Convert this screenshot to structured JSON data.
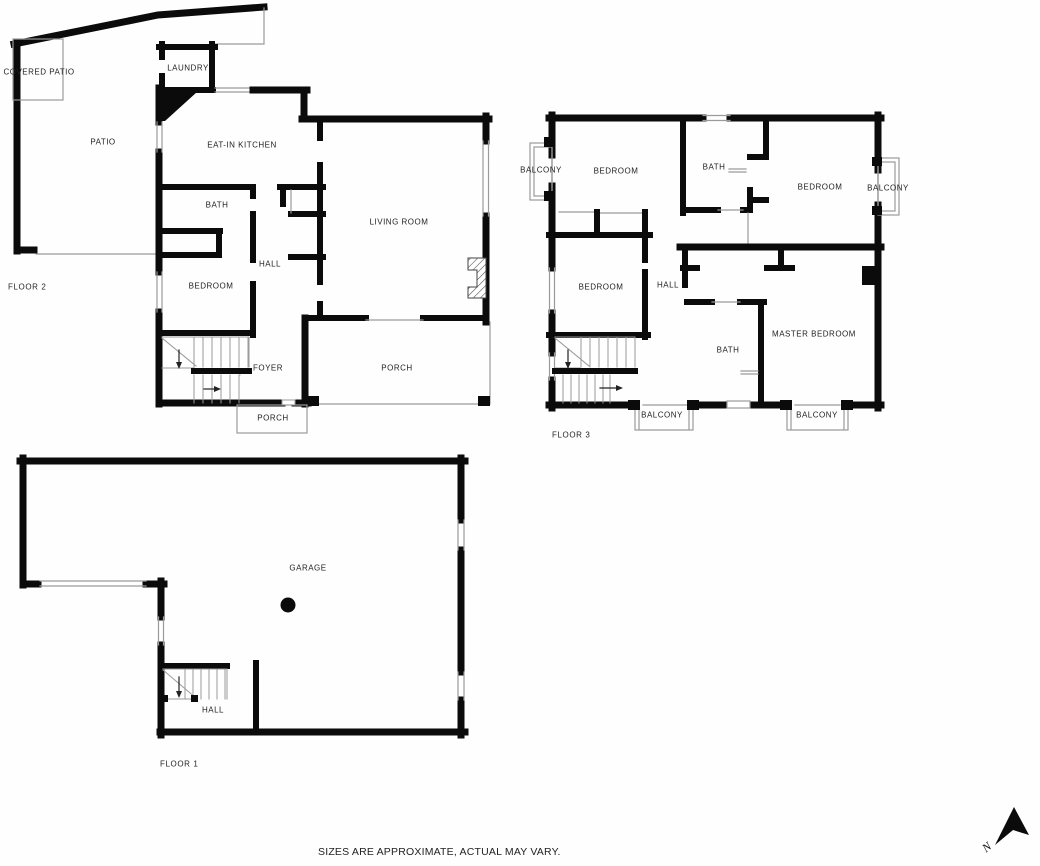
{
  "meta": {
    "title": "Three-floor residential floor plan",
    "wall_color": "#0b0b0b",
    "thin_line_color": "#9a9a9a",
    "background": "#fefefe"
  },
  "disclaimer": {
    "text": "SIZES ARE APPROXIMATE, ACTUAL MAY VARY."
  },
  "compass": {
    "label": "N",
    "icon": "north-arrow-icon"
  },
  "floors": [
    {
      "id": "floor-2",
      "name_label": {
        "text": "FLOOR 2",
        "x": 8,
        "y": 287
      },
      "rooms": [
        {
          "label": "COVERED PATIO",
          "x": 39,
          "y": 72
        },
        {
          "label": "PATIO",
          "x": 103,
          "y": 142
        },
        {
          "label": "LAUNDRY",
          "x": 188,
          "y": 68
        },
        {
          "label": "EAT-IN KITCHEN",
          "x": 242,
          "y": 145
        },
        {
          "label": "BATH",
          "x": 217,
          "y": 205
        },
        {
          "label": "HALL",
          "x": 270,
          "y": 264
        },
        {
          "label": "BEDROOM",
          "x": 211,
          "y": 286
        },
        {
          "label": "LIVING ROOM",
          "x": 399,
          "y": 222
        },
        {
          "label": "FOYER",
          "x": 268,
          "y": 368
        },
        {
          "label": "PORCH",
          "x": 397,
          "y": 368
        },
        {
          "label": "PORCH",
          "x": 273,
          "y": 418
        }
      ]
    },
    {
      "id": "floor-3",
      "name_label": {
        "text": "FLOOR 3",
        "x": 552,
        "y": 435
      },
      "rooms": [
        {
          "label": "BALCONY",
          "x": 541,
          "y": 170
        },
        {
          "label": "BEDROOM",
          "x": 616,
          "y": 171
        },
        {
          "label": "BATH",
          "x": 714,
          "y": 167
        },
        {
          "label": "BEDROOM",
          "x": 820,
          "y": 187
        },
        {
          "label": "BALCONY",
          "x": 888,
          "y": 188
        },
        {
          "label": "BEDROOM",
          "x": 601,
          "y": 287
        },
        {
          "label": "HALL",
          "x": 668,
          "y": 285
        },
        {
          "label": "MASTER BEDROOM",
          "x": 814,
          "y": 334
        },
        {
          "label": "BATH",
          "x": 728,
          "y": 350
        },
        {
          "label": "BALCONY",
          "x": 662,
          "y": 415
        },
        {
          "label": "BALCONY",
          "x": 817,
          "y": 415
        }
      ]
    },
    {
      "id": "floor-1",
      "name_label": {
        "text": "FLOOR 1",
        "x": 160,
        "y": 764
      },
      "rooms": [
        {
          "label": "GARAGE",
          "x": 308,
          "y": 568
        },
        {
          "label": "HALL",
          "x": 213,
          "y": 710
        }
      ]
    }
  ]
}
